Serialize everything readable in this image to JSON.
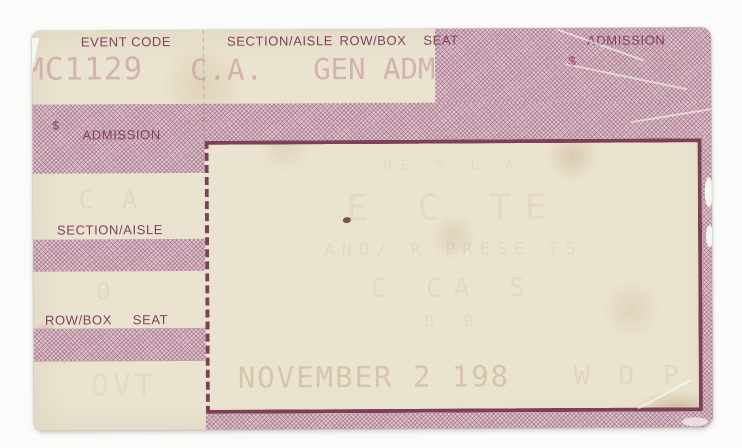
{
  "ticket": {
    "top_labels": {
      "event_code": "EVENT CODE",
      "section_aisle": "SECTION/AISLE",
      "row_box": "ROW/BOX",
      "seat": "SEAT",
      "admission": "ADMISSION"
    },
    "stamps": {
      "event_code": "MC1129",
      "section_aisle": "C.A.",
      "seat_class": "GEN ADM",
      "currency": "$",
      "price_faint": "19.50",
      "date": "NOVEMBER 2  198",
      "date_faint": "W D  P"
    },
    "left_panel": {
      "currency": "$",
      "admission": "ADMISSION",
      "section_aisle": "SECTION/AISLE",
      "row_box": "ROW/BOX",
      "seat": "SEAT",
      "ghost_section_value": "C A",
      "ghost_row_value": "0",
      "ghost_bottom": "OVT"
    },
    "inner_panel_ghosts": {
      "line1": "HE S C A",
      "line2": "E  C  TE",
      "line3": "AND/ R   PRESE TS",
      "line4": "C   CA    S",
      "line5": "D     0"
    },
    "colors": {
      "band_pink": "#c9a4b2",
      "label_plum": "#82405f",
      "border_maroon": "#7c4057",
      "paper_cream": "#eae3d0",
      "stamp_pink": "#c08e93",
      "stamp_tan": "#bf9c78"
    }
  }
}
